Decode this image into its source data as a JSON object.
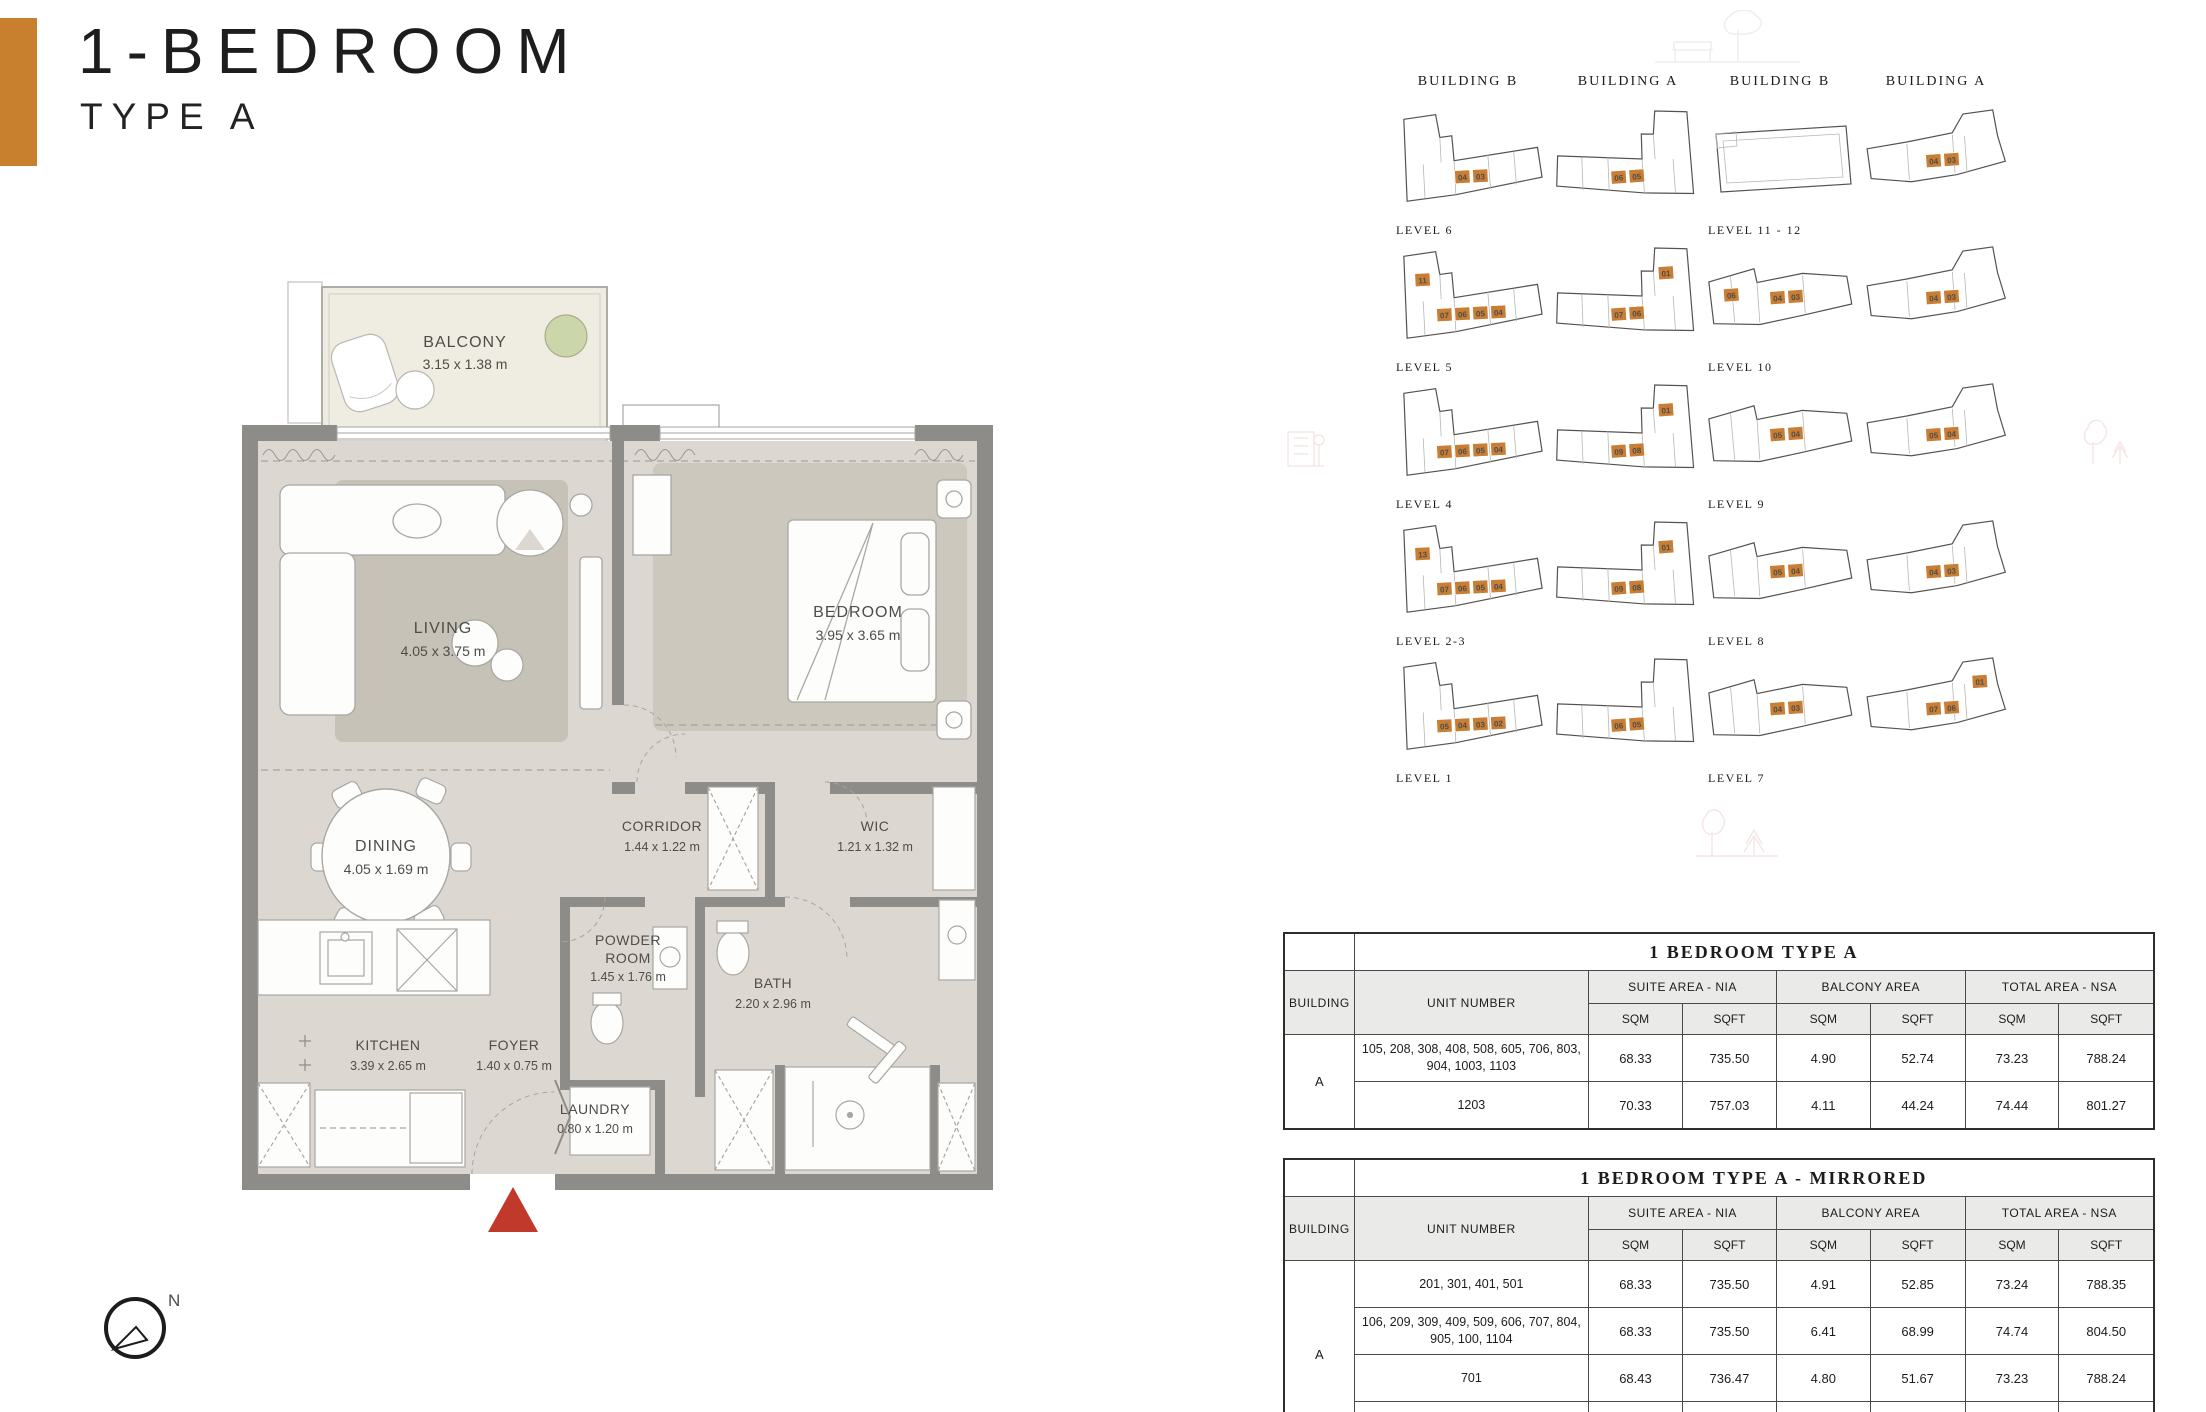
{
  "header": {
    "title": "1-BEDROOM",
    "subtitle": "TYPE A"
  },
  "colors": {
    "accent": "#c8802f",
    "unit_highlight": "#c87e35",
    "entrance_marker": "#c0392b",
    "wall": "#8e8c89",
    "floor": "#dcd8d1",
    "balcony_floor": "#efece2"
  },
  "plan": {
    "compass_label": "N",
    "rooms": {
      "balcony": {
        "name": "BALCONY",
        "dims": "3.15 x 1.38 m"
      },
      "living": {
        "name": "LIVING",
        "dims": "4.05 x 3.75 m"
      },
      "bedroom": {
        "name": "BEDROOM",
        "dims": "3.95 x 3.65 m"
      },
      "dining": {
        "name": "DINING",
        "dims": "4.05 x 1.69 m"
      },
      "corridor": {
        "name": "CORRIDOR",
        "dims": "1.44 x 1.22 m"
      },
      "wic": {
        "name": "WIC",
        "dims": "1.21 x 1.32 m"
      },
      "powder": {
        "name1": "POWDER",
        "name2": "ROOM",
        "dims": "1.45 x 1.76 m"
      },
      "bath": {
        "name": "BATH",
        "dims": "2.20 x 2.96 m"
      },
      "kitchen": {
        "name": "KITCHEN",
        "dims": "3.39 x 2.65 m"
      },
      "foyer": {
        "name": "FOYER",
        "dims": "1.40 x 0.75 m"
      },
      "laundry": {
        "name": "LAUNDRY",
        "dims": "0.80 x 1.20 m"
      }
    }
  },
  "icons": {
    "compass": "compass-icon",
    "entrance": "entrance-marker",
    "tree": "tree-icon",
    "watermarks": [
      "bench-tree-watermark",
      "building-watermark",
      "trees-watermark"
    ]
  },
  "key_plans": {
    "col_headers": [
      "BUILDING B",
      "BUILDING A",
      "BUILDING B",
      "BUILDING A"
    ],
    "cells": [
      {
        "col": 0,
        "row": 0,
        "shape": "bL",
        "units": [
          "04",
          "03"
        ],
        "label": "LEVEL 6"
      },
      {
        "col": 1,
        "row": 0,
        "shape": "aL",
        "units": [
          "06",
          "05"
        ]
      },
      {
        "col": 2,
        "row": 0,
        "shape": "rect",
        "units": [],
        "label": "LEVEL 11 - 12"
      },
      {
        "col": 3,
        "row": 0,
        "shape": "aS",
        "units": [
          "04",
          "03"
        ]
      },
      {
        "col": 0,
        "row": 1,
        "shape": "bL",
        "units": [
          "07",
          "06",
          "05",
          "04"
        ],
        "tower": "11",
        "label": "LEVEL 5"
      },
      {
        "col": 1,
        "row": 1,
        "shape": "aL",
        "units": [
          "07",
          "06"
        ],
        "tower": "01"
      },
      {
        "col": 2,
        "row": 1,
        "shape": "bS",
        "units": [
          "04",
          "03"
        ],
        "tower": "06",
        "label": "LEVEL 10"
      },
      {
        "col": 3,
        "row": 1,
        "shape": "aS",
        "units": [
          "04",
          "03"
        ]
      },
      {
        "col": 0,
        "row": 2,
        "shape": "bL",
        "units": [
          "07",
          "06",
          "05",
          "04"
        ],
        "label": "LEVEL 4"
      },
      {
        "col": 1,
        "row": 2,
        "shape": "aL",
        "units": [
          "09",
          "08"
        ],
        "tower": "01"
      },
      {
        "col": 2,
        "row": 2,
        "shape": "bS",
        "units": [
          "05",
          "04"
        ],
        "label": "LEVEL 9"
      },
      {
        "col": 3,
        "row": 2,
        "shape": "aS",
        "units": [
          "05",
          "04"
        ]
      },
      {
        "col": 0,
        "row": 3,
        "shape": "bL",
        "units": [
          "07",
          "06",
          "05",
          "04"
        ],
        "tower": "13",
        "label": "LEVEL 2-3"
      },
      {
        "col": 1,
        "row": 3,
        "shape": "aL",
        "units": [
          "09",
          "08"
        ],
        "tower": "01"
      },
      {
        "col": 2,
        "row": 3,
        "shape": "bS",
        "units": [
          "05",
          "04"
        ],
        "label": "LEVEL 8"
      },
      {
        "col": 3,
        "row": 3,
        "shape": "aS",
        "units": [
          "04",
          "03"
        ]
      },
      {
        "col": 0,
        "row": 4,
        "shape": "bL",
        "units": [
          "05",
          "04",
          "03",
          "02"
        ],
        "label": "LEVEL 1"
      },
      {
        "col": 1,
        "row": 4,
        "shape": "aL",
        "units": [
          "06",
          "05"
        ]
      },
      {
        "col": 2,
        "row": 4,
        "shape": "bS",
        "units": [
          "04",
          "03"
        ],
        "label": "LEVEL 7"
      },
      {
        "col": 3,
        "row": 4,
        "shape": "aS",
        "units": [
          "07",
          "06"
        ],
        "tower": "01"
      }
    ]
  },
  "tables": [
    {
      "title": "1 BEDROOM TYPE A",
      "building_header": "BUILDING",
      "unit_header": "UNIT NUMBER",
      "area_groups": [
        "SUITE AREA - NIA",
        "BALCONY AREA",
        "TOTAL AREA - NSA"
      ],
      "unit_subheaders": [
        "SQM",
        "SQFT"
      ],
      "building": "A",
      "rows": [
        {
          "units": "105, 208, 308, 408, 508, 605, 706, 803, 904, 1003, 1103",
          "values": [
            "68.33",
            "735.50",
            "4.90",
            "52.74",
            "73.23",
            "788.24"
          ]
        },
        {
          "units": "1203",
          "values": [
            "70.33",
            "757.03",
            "4.11",
            "44.24",
            "74.44",
            "801.27"
          ]
        }
      ]
    },
    {
      "title": "1 BEDROOM TYPE A - MIRRORED",
      "building_header": "BUILDING",
      "unit_header": "UNIT NUMBER",
      "area_groups": [
        "SUITE AREA - NIA",
        "BALCONY AREA",
        "TOTAL AREA - NSA"
      ],
      "unit_subheaders": [
        "SQM",
        "SQFT"
      ],
      "building": "A",
      "rows": [
        {
          "units": "201, 301, 401, 501",
          "values": [
            "68.33",
            "735.50",
            "4.91",
            "52.85",
            "73.24",
            "788.35"
          ]
        },
        {
          "units": "106, 209, 309, 409, 509, 606, 707, 804, 905, 100, 1104",
          "values": [
            "68.33",
            "735.50",
            "6.41",
            "68.99",
            "74.74",
            "804.50"
          ]
        },
        {
          "units": "701",
          "values": [
            "68.43",
            "736.47",
            "4.80",
            "51.67",
            "73.23",
            "788.24"
          ]
        },
        {
          "units": "1204",
          "values": [
            "70.60",
            "759.93",
            "5.48",
            "58.99",
            "76.08",
            "818.92"
          ]
        }
      ]
    }
  ]
}
